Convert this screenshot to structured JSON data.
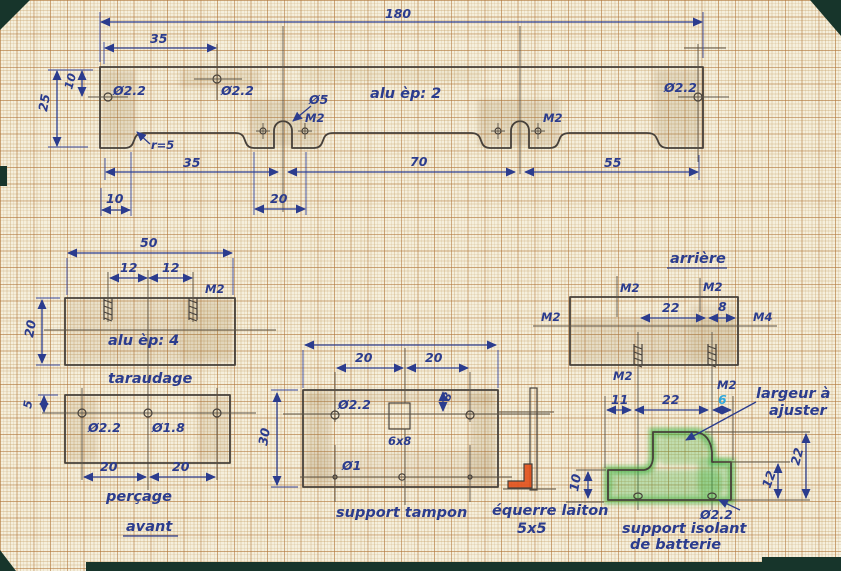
{
  "colors": {
    "ink": "#2b3c8e",
    "pencil": "#46403a",
    "green": "#38b13e",
    "orange": "#e2521d",
    "cyan": "#2fa7dc",
    "paper": "#f5efdc"
  },
  "main_plate": {
    "note": "alu èp: 2",
    "d180": "180",
    "d35_top": "35",
    "d25": "25",
    "d10_left": "10",
    "hole_left": "Ø2.2",
    "hole_mid": "Ø2.2",
    "hole_right": "Ø2.2",
    "notch": "Ø5",
    "m2_left": "M2",
    "m2_right": "M2",
    "r5": "r=5",
    "d35": "35",
    "d70": "70",
    "d55": "55",
    "d10": "10",
    "d20": "20"
  },
  "taraudage": {
    "caption": "taraudage",
    "note": "alu èp: 4",
    "d50": "50",
    "d12a": "12",
    "d12b": "12",
    "m2": "M2",
    "d20": "20"
  },
  "percage": {
    "caption": "perçage",
    "view": "avant",
    "d5": "5",
    "hole1": "Ø2.2",
    "hole2": "Ø1.8",
    "d20a": "20",
    "d20b": "20"
  },
  "tampon": {
    "caption": "support tampon",
    "d20a": "20",
    "d20b": "20",
    "hole_top": "Ø2.2",
    "slot": "6x8",
    "d8": "8",
    "hole_bottom": "Ø1",
    "d30": "30"
  },
  "equerre": {
    "caption1": "équerre laiton",
    "caption2": "5x5"
  },
  "arriere": {
    "title": "arrière",
    "m2_tl": "M2",
    "m2_tr": "M2",
    "d22": "22",
    "d8": "8",
    "m2_side": "M2",
    "m4_side": "M4",
    "m2_bl": "M2",
    "m2_br": "M2"
  },
  "isolant": {
    "caption1": "support isolant",
    "caption2": "de batterie",
    "note1": "largeur à",
    "note2": "ajuster",
    "d11": "11",
    "d22": "22",
    "d6": "6",
    "d10": "10",
    "d12": "12",
    "dv22": "22",
    "hole": "Ø2.2"
  }
}
